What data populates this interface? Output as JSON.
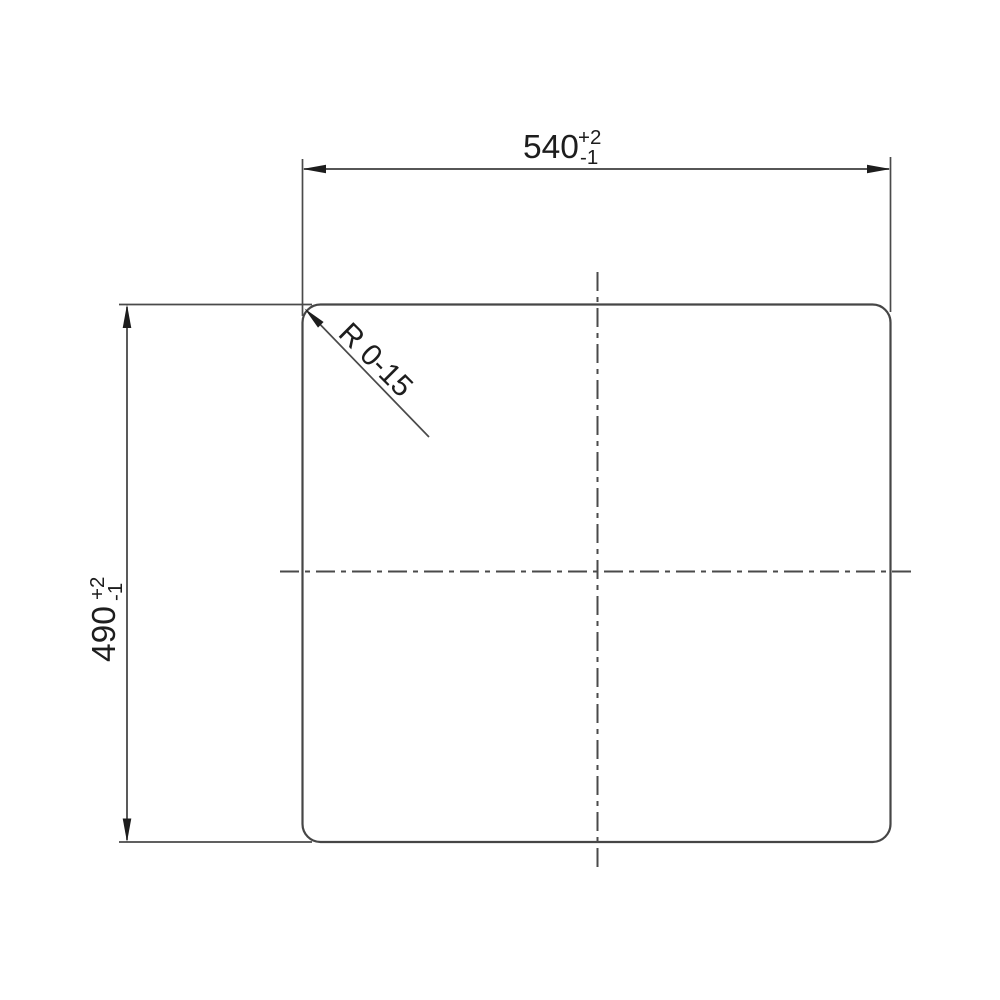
{
  "drawing": {
    "width_dimension": {
      "value": "540",
      "tolerance_plus": "+2",
      "tolerance_minus": "-1"
    },
    "height_dimension": {
      "value": "490",
      "tolerance_plus": "+2",
      "tolerance_minus": "-1"
    },
    "corner_radius": {
      "label": "R 0-15"
    },
    "colors": {
      "line": "#464646",
      "text": "#1d1d1d",
      "background": "#ffffff"
    }
  }
}
